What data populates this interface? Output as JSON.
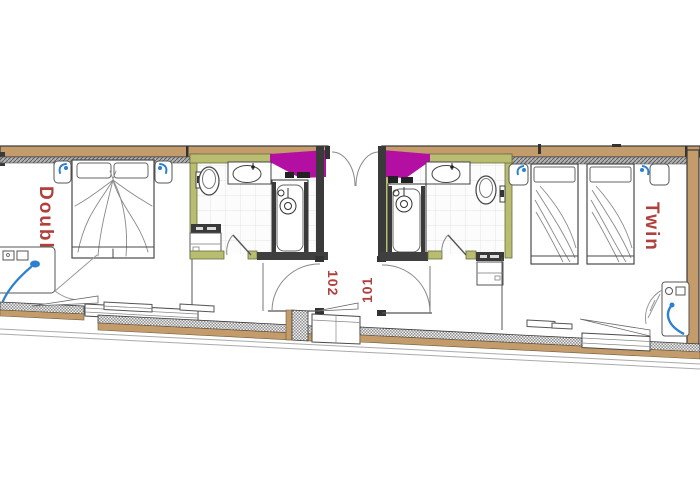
{
  "rooms": {
    "double": {
      "name": "Double",
      "number": "102"
    },
    "twin": {
      "name": "Twin",
      "number": "101"
    }
  },
  "colors": {
    "label-red": "#b0403c",
    "wall-tan": "#c49c6b",
    "wall-dark": "#3a3a3a",
    "bath-olive": "#b9bd72",
    "accent-magenta": "#b30fa3",
    "fixture-blue": "#2e7fd0"
  }
}
